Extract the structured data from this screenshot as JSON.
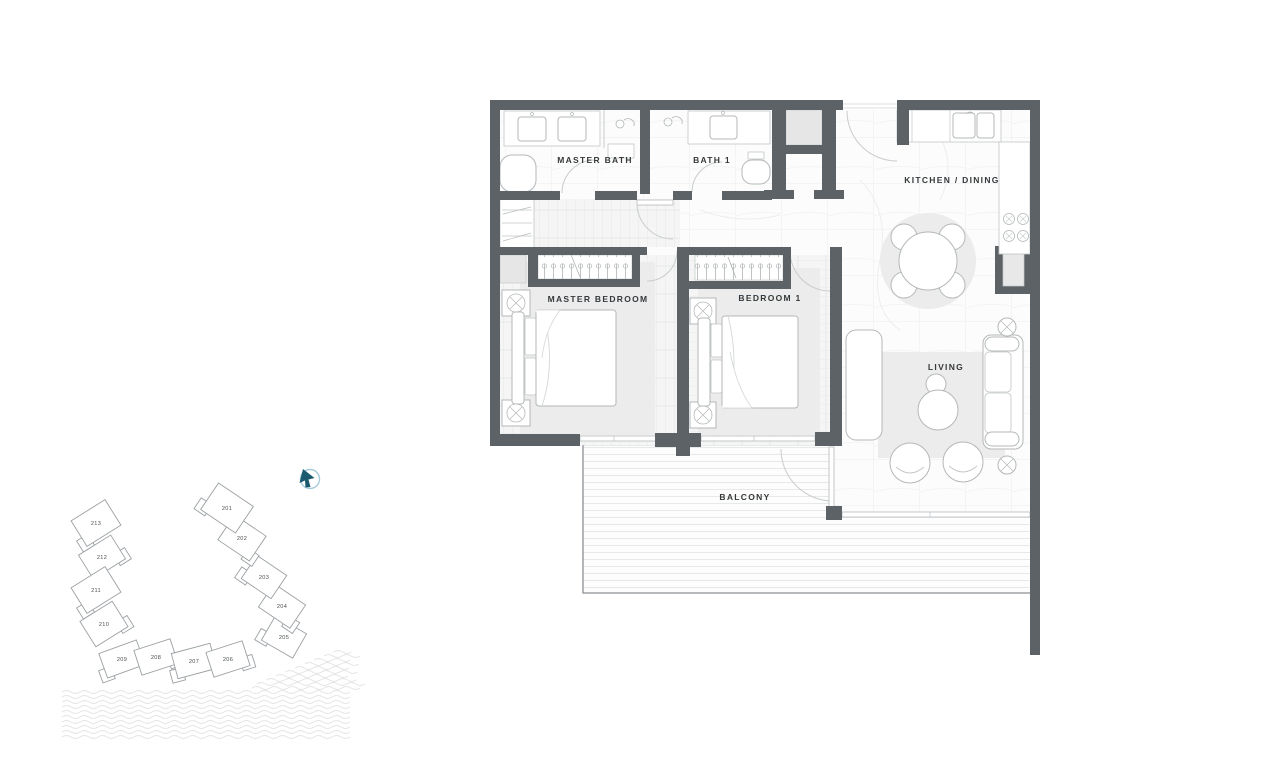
{
  "floor_plan": {
    "rooms": {
      "master_bath": {
        "label": "MASTER BATH"
      },
      "bath_1": {
        "label": "BATH 1"
      },
      "kitchen_dining": {
        "label": "KITCHEN / DINING"
      },
      "master_bedroom": {
        "label": "MASTER BEDROOM"
      },
      "bedroom_1": {
        "label": "BEDROOM 1"
      },
      "living": {
        "label": "LIVING"
      },
      "balcony": {
        "label": "BALCONY"
      }
    }
  },
  "site_key": {
    "highlighted_unit": "211",
    "units": [
      {
        "label": "213",
        "cx": 96,
        "cy": 523,
        "w": 40,
        "h": 30,
        "rot": -32,
        "highlighted": false
      },
      {
        "label": "212",
        "cx": 102,
        "cy": 557,
        "w": 38,
        "h": 28,
        "rot": -32,
        "highlighted": false
      },
      {
        "label": "211",
        "cx": 96,
        "cy": 590,
        "w": 40,
        "h": 30,
        "rot": -32,
        "highlighted": true
      },
      {
        "label": "210",
        "cx": 104,
        "cy": 624,
        "w": 38,
        "h": 30,
        "rot": -32,
        "highlighted": false
      },
      {
        "label": "209",
        "cx": 122,
        "cy": 659,
        "w": 40,
        "h": 26,
        "rot": -20,
        "highlighted": false
      },
      {
        "label": "208",
        "cx": 156,
        "cy": 657,
        "w": 38,
        "h": 26,
        "rot": -18,
        "highlighted": false
      },
      {
        "label": "207",
        "cx": 194,
        "cy": 661,
        "w": 40,
        "h": 26,
        "rot": -15,
        "highlighted": false
      },
      {
        "label": "206",
        "cx": 228,
        "cy": 659,
        "w": 38,
        "h": 26,
        "rot": -18,
        "highlighted": false
      },
      {
        "label": "205",
        "cx": 284,
        "cy": 637,
        "w": 36,
        "h": 28,
        "rot": 30,
        "highlighted": false
      },
      {
        "label": "204",
        "cx": 282,
        "cy": 606,
        "w": 38,
        "h": 28,
        "rot": 34,
        "highlighted": false
      },
      {
        "label": "203",
        "cx": 264,
        "cy": 577,
        "w": 36,
        "h": 28,
        "rot": 34,
        "highlighted": false
      },
      {
        "label": "202",
        "cx": 242,
        "cy": 538,
        "w": 38,
        "h": 30,
        "rot": 34,
        "highlighted": false
      },
      {
        "label": "201",
        "cx": 227,
        "cy": 508,
        "w": 42,
        "h": 32,
        "rot": 34,
        "highlighted": false
      }
    ]
  },
  "colors": {
    "wall": "#5d6266",
    "unit_highlight": "#a9d6e6",
    "compass_arrow": "#1b5a6e",
    "compass_ring": "#a5cbd8"
  }
}
